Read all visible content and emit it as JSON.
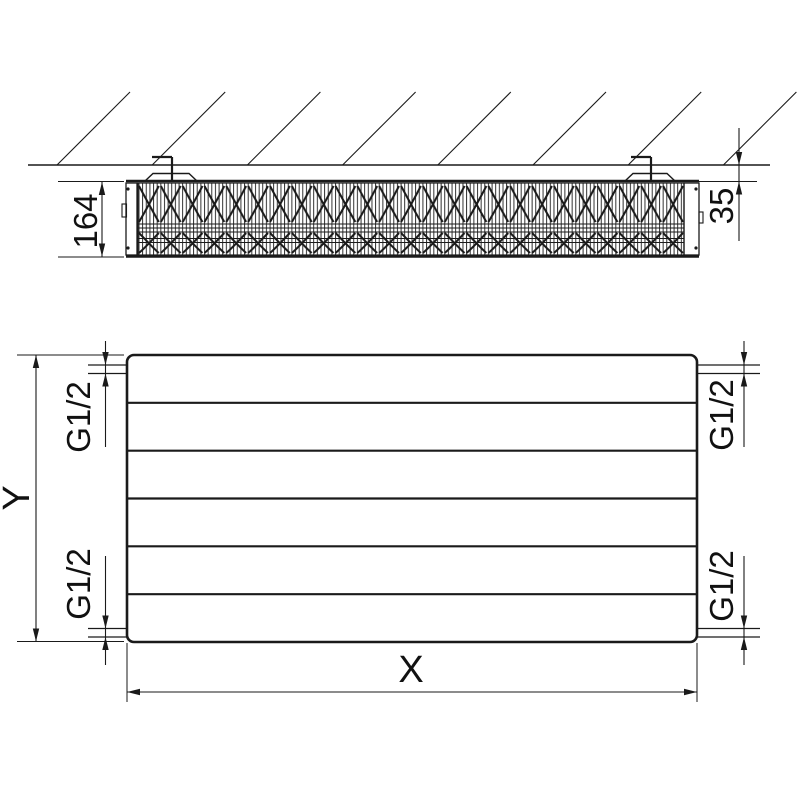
{
  "colors": {
    "line": "#1a1a1a",
    "background": "#ffffff"
  },
  "top_view": {
    "depth_dimension_label": "164",
    "wall_distance_dimension_label": "35"
  },
  "front_view": {
    "height_dimension_label": "Y",
    "width_dimension_label": "X",
    "connection_top_left_label": "G1/2",
    "connection_top_right_label": "G1/2",
    "connection_bottom_left_label": "G1/2",
    "connection_bottom_right_label": "G1/2"
  }
}
